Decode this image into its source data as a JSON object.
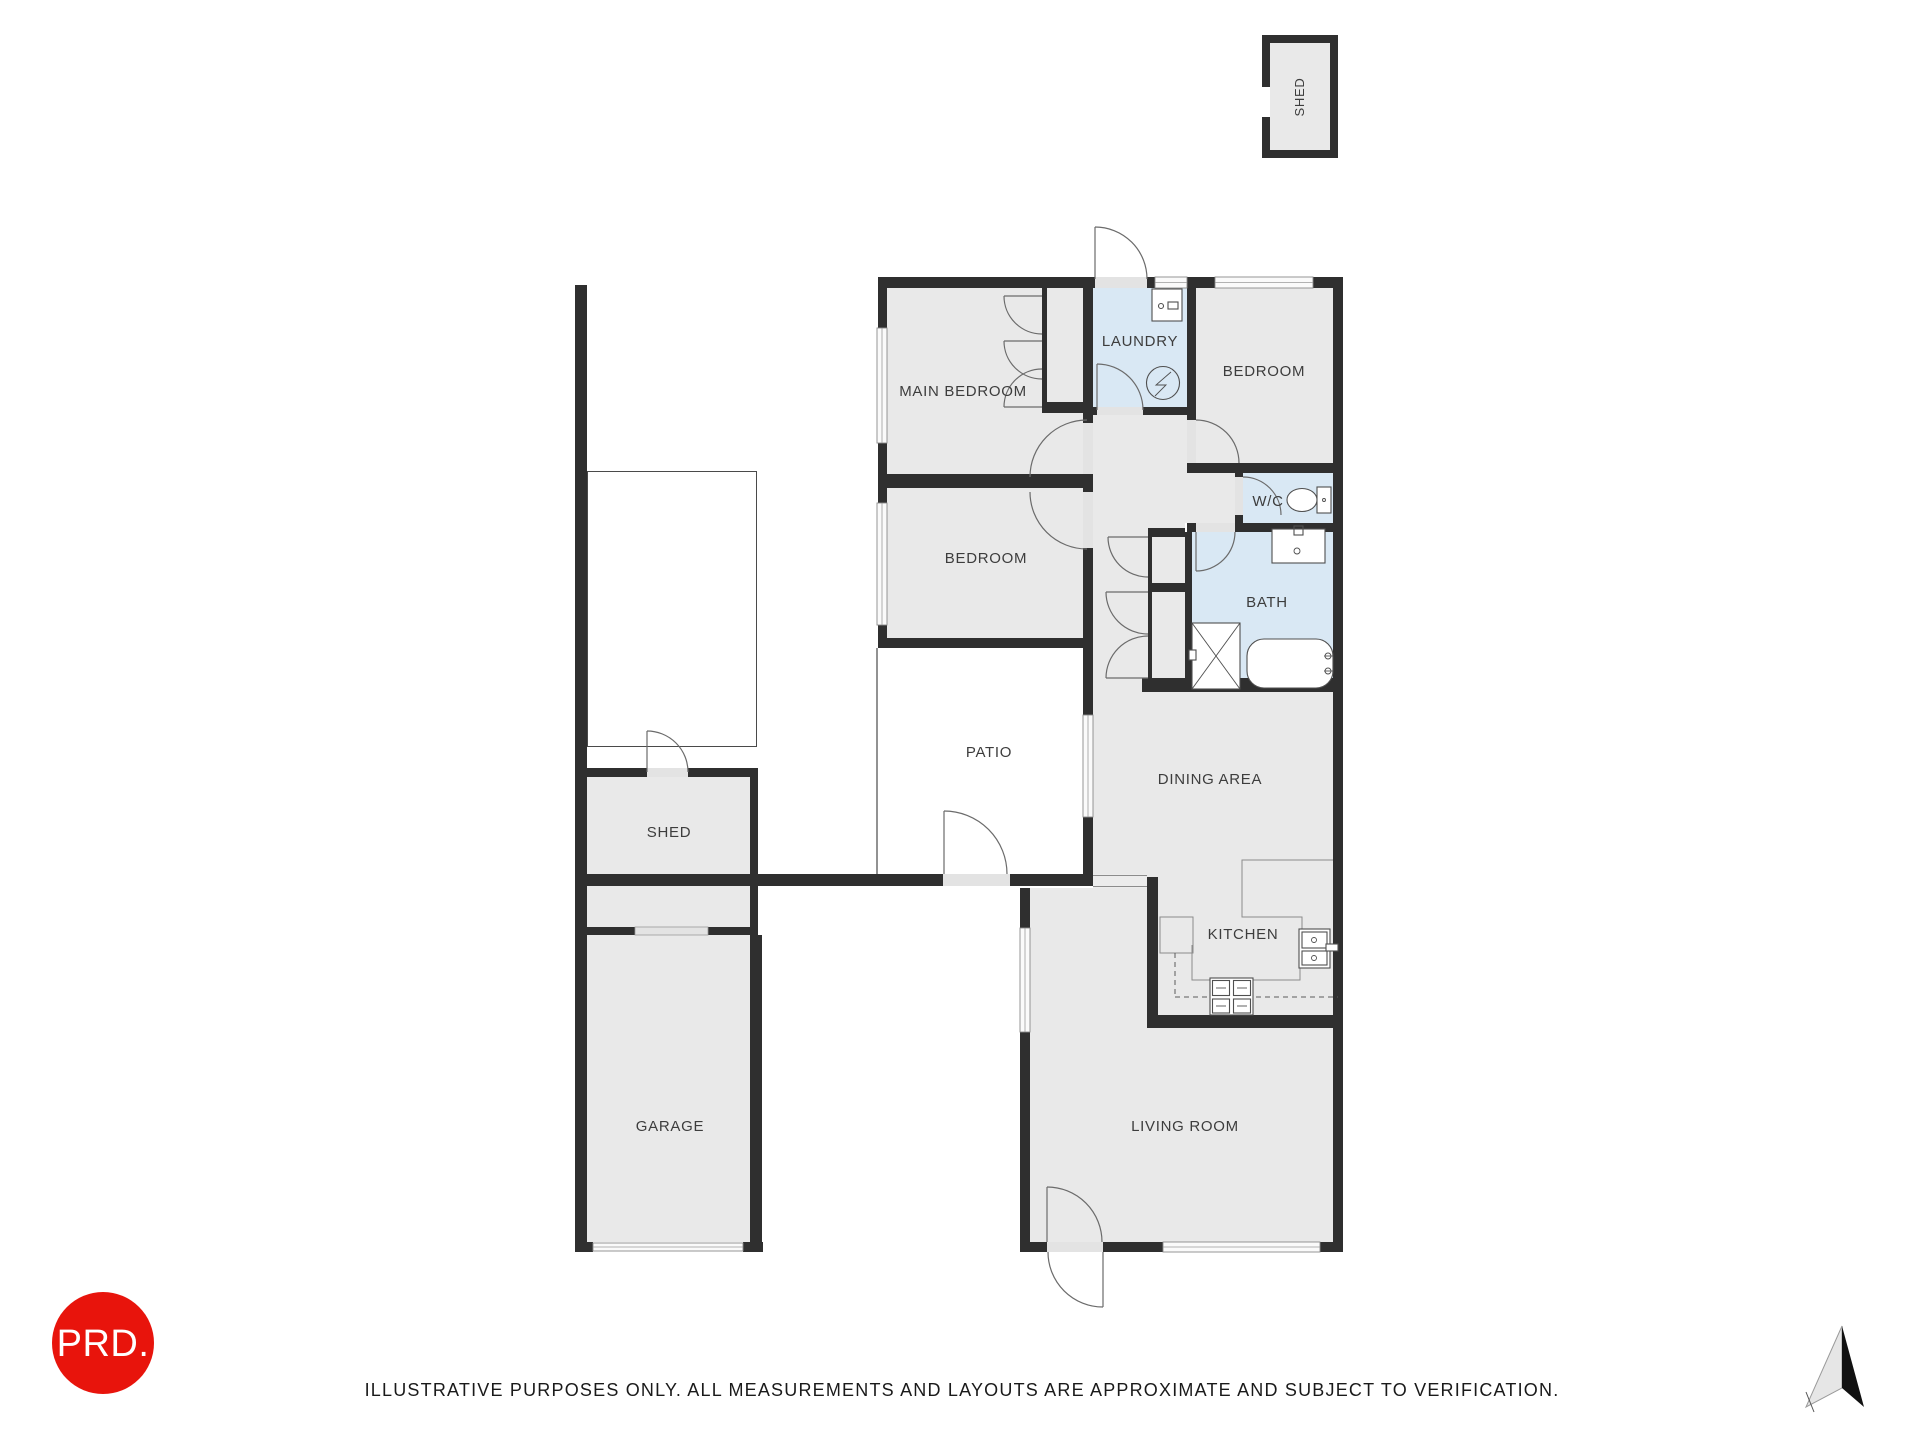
{
  "rooms": {
    "shed_top": {
      "label": "SHED"
    },
    "main_bedroom": {
      "label": "MAIN BEDROOM"
    },
    "laundry": {
      "label": "LAUNDRY"
    },
    "bedroom_right": {
      "label": "BEDROOM"
    },
    "wc": {
      "label": "W/C"
    },
    "bedroom_left": {
      "label": "BEDROOM"
    },
    "bath": {
      "label": "BATH"
    },
    "patio": {
      "label": "PATIO"
    },
    "dining": {
      "label": "DINING AREA"
    },
    "shed_left": {
      "label": "SHED"
    },
    "kitchen": {
      "label": "KITCHEN"
    },
    "garage": {
      "label": "GARAGE"
    },
    "living": {
      "label": "LIVING ROOM"
    }
  },
  "fixtures": {
    "laundry_appliance": "washing-machine",
    "laundry_meter": "electrical-meter",
    "wc_fixture": "toilet",
    "bath_fixtures": [
      "vanity-sink",
      "shower",
      "bathtub"
    ],
    "kitchen_fixtures": [
      "kitchen-sink",
      "stove"
    ]
  },
  "branding": {
    "logo_text": "PRD."
  },
  "footer": {
    "disclaimer": "ILLUSTRATIVE PURPOSES ONLY. ALL MEASUREMENTS AND LAYOUTS ARE APPROXIMATE AND SUBJECT TO VERIFICATION."
  },
  "compass": {
    "icon": "north-arrow"
  },
  "colors": {
    "wall": "#2f2f2f",
    "room_fill": "#e9e9e9",
    "wet_room_fill": "#d9e8f4",
    "outdoor_fill": "#ffffff",
    "logo_red": "#e8140c"
  }
}
